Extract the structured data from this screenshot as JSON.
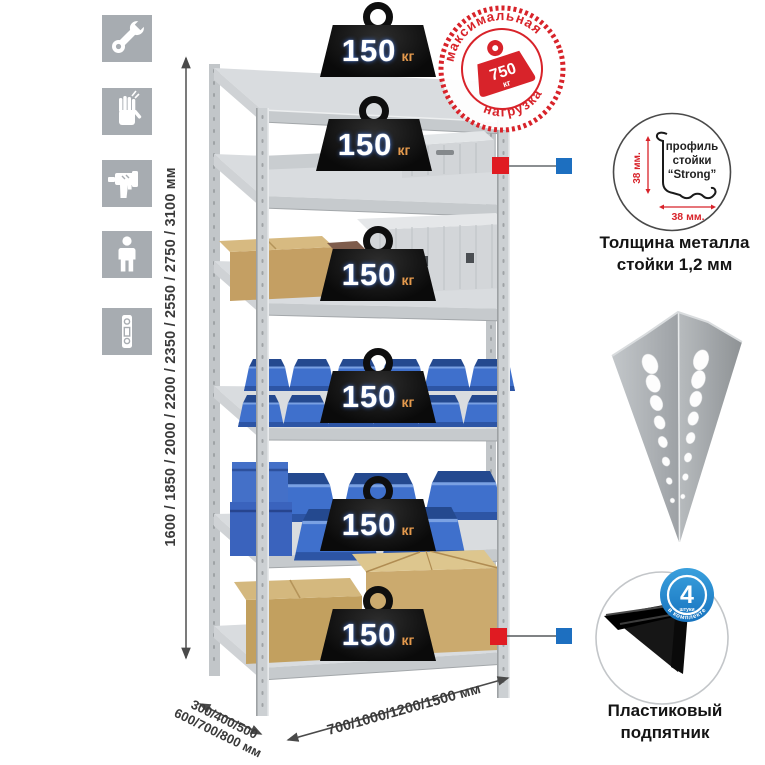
{
  "sidebar": {
    "icons": [
      {
        "name": "wrench"
      },
      {
        "name": "gloves"
      },
      {
        "name": "drill"
      },
      {
        "name": "person"
      },
      {
        "name": "level"
      }
    ]
  },
  "rack": {
    "shelf_count": 6,
    "shelf_load": {
      "value": "150",
      "unit": "кг"
    },
    "max_load": {
      "arc_top": "максимальная",
      "arc_bottom": "нагрузка",
      "value": "750",
      "unit": "кг"
    }
  },
  "dimensions": {
    "height": "1600 / 1850 / 2000 / 2200 / 2350 / 2550 / 2750 / 3100 мм",
    "depth_line1": "300/400/500",
    "depth_line2": "600/700/800 мм",
    "width": "700/1000/1200/1500 мм"
  },
  "profile_detail": {
    "label_line1": "профиль",
    "label_line2": "стойки",
    "label_line3": "“Strong”",
    "dim_vertical": "38 мм.",
    "dim_horizontal": "38 мм.",
    "caption_line1": "Толщина металла",
    "caption_line2": "стойки 1,2 мм"
  },
  "foot_detail": {
    "badge_value": "4",
    "badge_unit": "штуки",
    "badge_arc": "в комплекте",
    "caption_line1": "Пластиковый",
    "caption_line2": "подпятник"
  },
  "colors": {
    "accent_red": "#d8232a",
    "marker_red": "#e01b22",
    "marker_blue": "#1d6fc0",
    "badge_blue": "#1e86d0",
    "bin_blue": "#3f70cc",
    "load_unit_orange": "#e59a4d"
  }
}
